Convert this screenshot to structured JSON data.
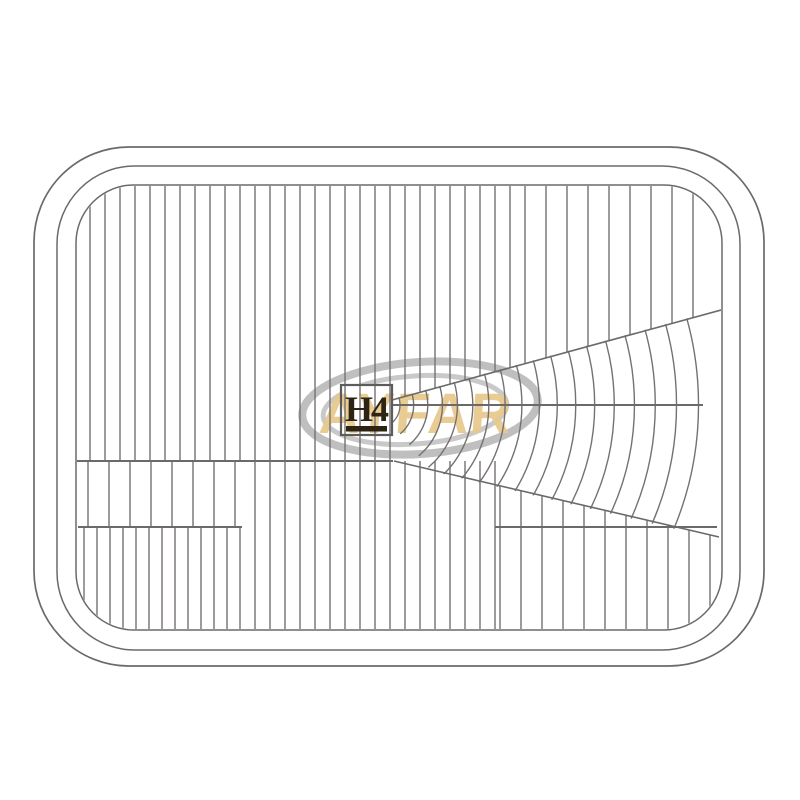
{
  "image": {
    "description": "Technical line drawing of a rectangular fluted headlight lens",
    "background": "#ffffff"
  },
  "lens_marking": {
    "text": "H4",
    "color": "#2e2413",
    "underline": true
  },
  "watermark": {
    "text": "AYFAR",
    "text_color": "#e8c98c",
    "ellipse_color": "#bfbfbf",
    "ellipse_color_inner": "#c9c9c9"
  },
  "drawing": {
    "canvas": {
      "w": 800,
      "h": 800
    },
    "stroke": {
      "border": "#6a6a6a",
      "flute": "#757170",
      "accent": "#5c5c5c"
    },
    "borders": [
      {
        "x": 34,
        "y": 147,
        "w": 730,
        "h": 519,
        "r": 95,
        "sw": 1.7
      },
      {
        "x": 57,
        "y": 166,
        "w": 683,
        "h": 484,
        "r": 78,
        "sw": 1.5
      },
      {
        "x": 76,
        "y": 185,
        "w": 646,
        "h": 445,
        "r": 58,
        "sw": 1.5
      }
    ],
    "flute_groups": [
      {
        "name": "main-dense",
        "x0": 90,
        "dx": 15,
        "x1": 531,
        "y1": 186,
        "y2": "main"
      },
      {
        "name": "main-sparse-right",
        "x0": 546,
        "dx": 21,
        "x1": 713,
        "y1": 186,
        "y2": "main"
      },
      {
        "name": "mid-bottom",
        "x0": 255,
        "dx": 15,
        "x1": 496,
        "y1": 461,
        "y2": 630
      },
      {
        "name": "left-band-sparse",
        "x0": 88,
        "dx": 21,
        "x1": 240,
        "y1": 462,
        "y2": 527
      },
      {
        "name": "left-bottom-dense",
        "x0": 84,
        "dx": 13,
        "x1": 240,
        "y1": 527,
        "y2": 630
      },
      {
        "name": "right-bottom-sparse",
        "x0": 500,
        "dx": 21,
        "x1": 714,
        "y1": "lower",
        "y2": 630
      }
    ],
    "horizontals": [
      [
        76,
        461,
        393,
        461
      ],
      [
        78,
        527,
        242,
        527
      ],
      [
        495,
        527,
        717,
        527
      ],
      [
        392,
        405,
        703,
        405
      ]
    ],
    "diagonals": {
      "upper": [
        392,
        400,
        721,
        310
      ],
      "lower": [
        394,
        461,
        719,
        537
      ]
    },
    "fan": {
      "cx": 376,
      "cy": 405,
      "r0": 24,
      "rmax": 344,
      "dr_base": 13,
      "dr_growth": 0.03,
      "angle_deg": 50,
      "clip_points": "392,399 721,309 721,540 393,462"
    },
    "marking_box": {
      "x": 341,
      "y": 385,
      "w": 51,
      "h": 50,
      "sw": 2.2,
      "underline": {
        "x": 346,
        "y": 426,
        "w": 41,
        "h": 5.5
      },
      "text_x": 366,
      "text_y": 421,
      "font_size": 36,
      "letter_spacing": -2
    },
    "watermark_geo": {
      "ellipses": [
        {
          "cx": 420,
          "cy": 408,
          "rx": 118,
          "ry": 46,
          "sw": 8,
          "rot": -4,
          "which": "outer"
        },
        {
          "cx": 415,
          "cy": 410,
          "rx": 92,
          "ry": 34,
          "sw": 5,
          "rot": -4,
          "which": "inner"
        }
      ],
      "text_x": 318,
      "text_y": 433,
      "font_size": 57,
      "letter_spacing": 1,
      "skew": -4,
      "opacity": 0.93
    }
  }
}
